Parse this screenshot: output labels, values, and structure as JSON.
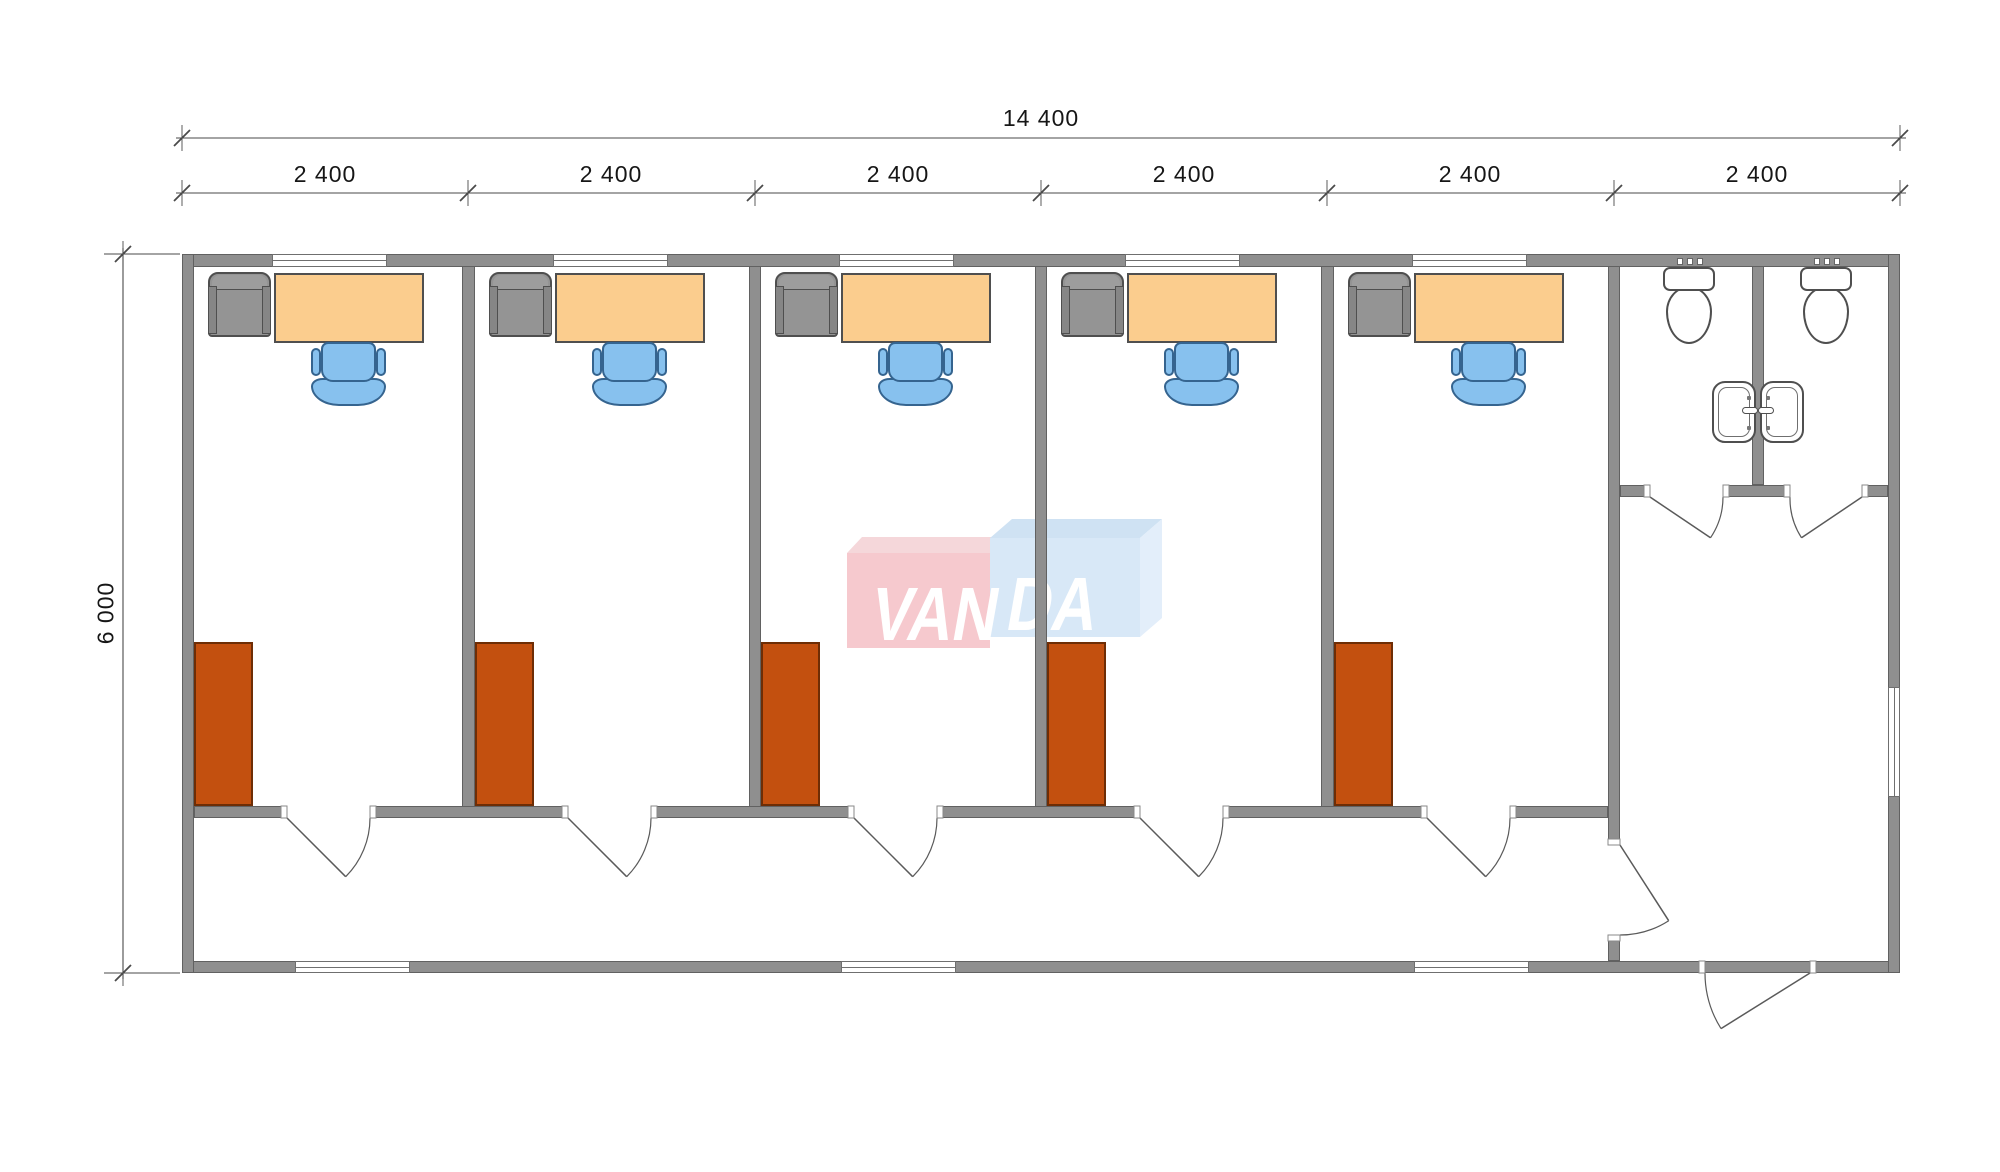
{
  "dimensions": {
    "total_width": "14 400",
    "modules": [
      "2 400",
      "2 400",
      "2 400",
      "2 400",
      "2 400",
      "2 400"
    ],
    "total_height": "6 000"
  },
  "watermark": {
    "left": "VAN",
    "right": "DA"
  },
  "colors": {
    "wall": "#8f8f8f",
    "wall_outline": "#616161",
    "desk": "#fbcd8e",
    "chair": "#87c1ee",
    "chair_outline": "#35648f",
    "cabinet": "#c3500f",
    "cabinet_outline": "#6e2d05",
    "armchair": "#949494",
    "dim": "#4a4a4a",
    "logo_red": "#f6c9ce",
    "logo_red_top": "#f5d7da",
    "logo_blue": "#d8e8f7",
    "logo_blue_top": "#cfe2f3",
    "logo_blue_side": "#e3eefa"
  }
}
